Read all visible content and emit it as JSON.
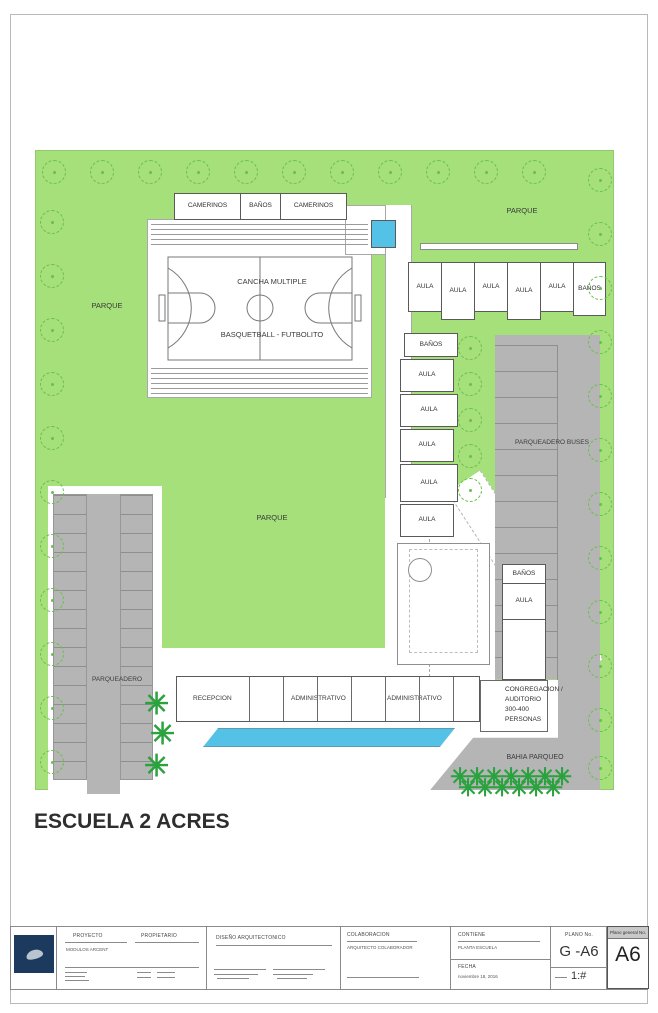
{
  "sheet_title": "ESCUELA 2 ACRES",
  "colors": {
    "site_green": "#a5e07a",
    "parking_gray": "#b5b5b5",
    "water_blue": "#54c1e6",
    "logo_navy": "#1c3a5e",
    "tree_green": "#6abf4d"
  },
  "site": {
    "park_left": "PARQUE",
    "park_top": "PARQUE",
    "park_center": "PARQUE",
    "court": {
      "title": "CANCHA MULTIPLE",
      "subtitle": "BASQUETBALL - FUTBOLITO",
      "top_rooms": [
        "CAMERINOS",
        "BAÑOS",
        "CAMERINOS"
      ]
    },
    "aula_row": [
      "AULA",
      "AULA",
      "AULA",
      "AULA",
      "AULA",
      "BAÑOS"
    ],
    "aula_col": [
      "BAÑOS",
      "AULA",
      "AULA",
      "AULA",
      "AULA",
      "AULA"
    ],
    "aud_rooms": [
      "BAÑOS",
      "AULA"
    ],
    "congregation_lines": [
      "CONGREGACION /",
      "AUDITORIO",
      "300-400",
      "PERSONAS"
    ],
    "admin": [
      "RECEPCION",
      "ADMINISTRATIVO",
      "ADMINISTRATIVO"
    ],
    "bus_parking_label": "PARQUEADERO BUSES",
    "parking_label": "PARQUEADERO",
    "road_label": "BAHIA PARQUEO"
  },
  "title_block": {
    "proyecto_label": "PROYECTO",
    "propietario_label": "PROPIETARIO",
    "proyecto_value": "MODULOS ARCENT",
    "diseno_label": "DISEÑO ARQUITECTONICO",
    "colaboracion_label": "COLABORACION",
    "colaboracion_value": "ARQUITECTO COLABORADOR",
    "contiene_label": "CONTIENE",
    "contiene_value": "PLANTA ESCUELA",
    "fecha_label": "FECHA",
    "fecha_value": "noviembre 18, 2016",
    "plano_no_label": "PLANO No.",
    "plano_no_value": "G -A6",
    "escala_value": "1:#",
    "plano_general_label": "Plano general No.",
    "plano_general_value": "A6"
  }
}
